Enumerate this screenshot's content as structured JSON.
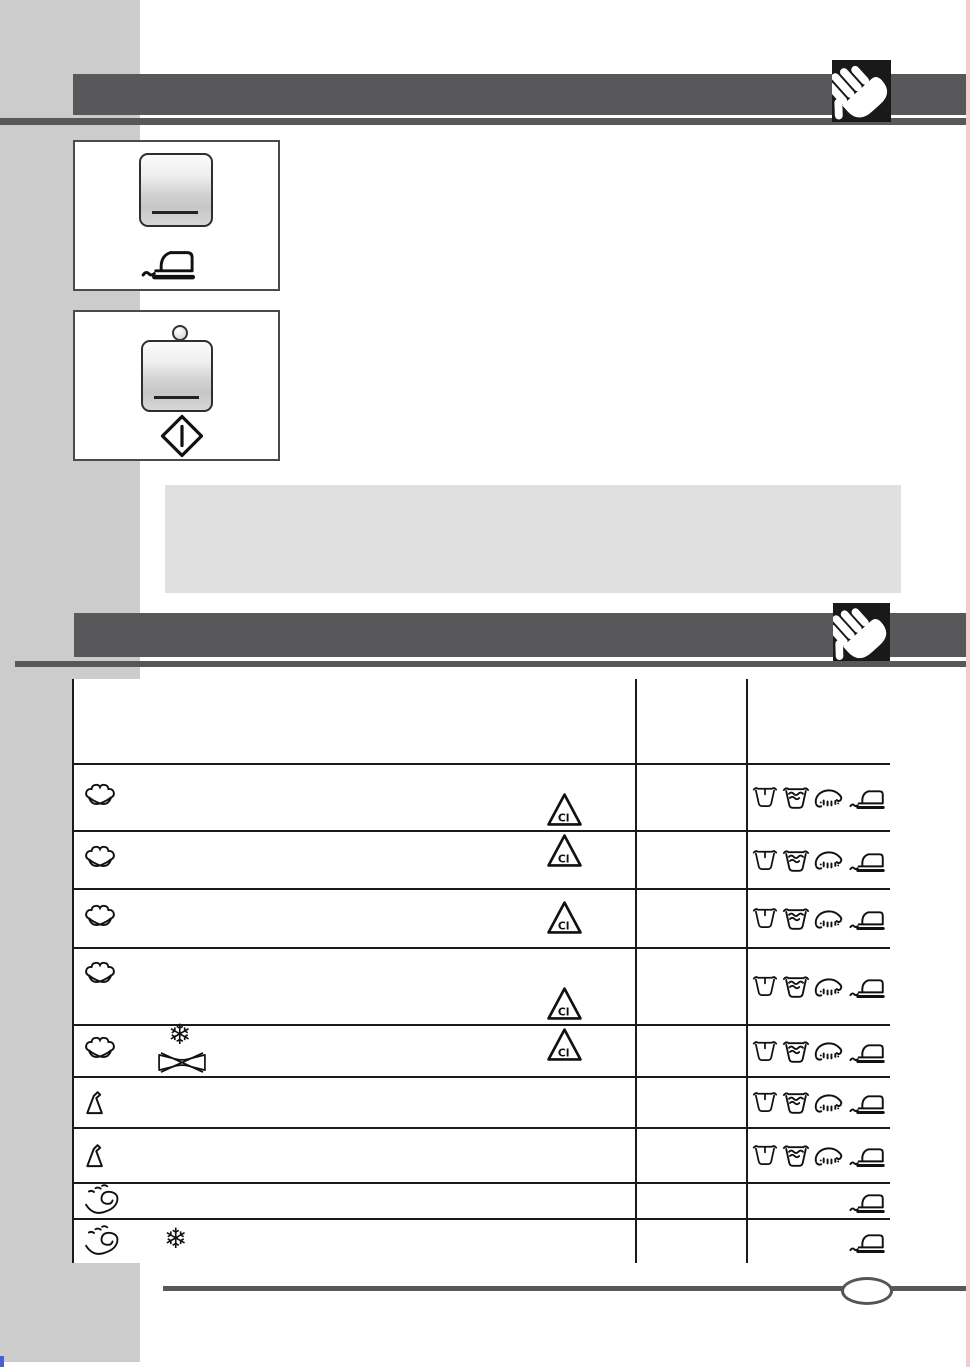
{
  "document": {
    "type": "washing-machine-manual-page",
    "visible_text": "Cl"
  },
  "colors": {
    "page_bg": "#ffffff",
    "sidebar": "#cccccc",
    "band_dark": "#58585a",
    "note_box": "#e0e0e0",
    "table_line": "#1a1a1a",
    "hand_box": "#191919",
    "scan_artifact_pink": "#f2cbcb",
    "scan_artifact_blue": "#4a5fd0"
  },
  "labels": {
    "bleach": "Cl"
  },
  "header1": {
    "icon": "hand-icon"
  },
  "header2": {
    "icon": "hand-icon"
  },
  "panels": [
    {
      "name": "easy-iron-button-panel",
      "elements": [
        "push-button",
        "iron-icon"
      ]
    },
    {
      "name": "start-button-panel",
      "elements": [
        "led-indicator",
        "push-button",
        "start-diamond-icon"
      ]
    }
  ],
  "note_box": {
    "text": ""
  },
  "table": {
    "header_row": {
      "col1": "",
      "col2": "",
      "col3": ""
    },
    "care_icon_legend": {
      "wash": "wash-tub-icon",
      "rinse": "rinse-tub-icon",
      "spin": "spin-dry-icon",
      "iron": "iron-icon"
    },
    "rows": [
      {
        "name": "cotton-program-1",
        "fabric": "cotton",
        "extras": [],
        "bleach": "bottom",
        "care": [
          "wash",
          "rinse",
          "spin",
          "iron"
        ]
      },
      {
        "name": "cotton-program-2",
        "fabric": "cotton",
        "extras": [],
        "bleach": "top",
        "care": [
          "wash",
          "rinse",
          "spin",
          "iron"
        ]
      },
      {
        "name": "cotton-program-3",
        "fabric": "cotton",
        "extras": [],
        "bleach": "center",
        "care": [
          "wash",
          "rinse",
          "spin",
          "iron"
        ]
      },
      {
        "name": "cotton-program-4",
        "fabric": "cotton",
        "extras": [],
        "bleach": "bottom",
        "care": [
          "wash",
          "rinse",
          "spin",
          "iron"
        ]
      },
      {
        "name": "cotton-cold-program",
        "fabric": "cotton",
        "extras": [
          "snowflake",
          "no-wring"
        ],
        "bleach": "top",
        "care": [
          "wash",
          "rinse",
          "spin",
          "iron"
        ]
      },
      {
        "name": "synthetics-program-1",
        "fabric": "synthetics",
        "extras": [],
        "bleach": null,
        "care": [
          "wash",
          "rinse",
          "spin",
          "iron"
        ]
      },
      {
        "name": "synthetics-program-2",
        "fabric": "synthetics",
        "extras": [],
        "bleach": null,
        "care": [
          "wash",
          "rinse",
          "spin",
          "iron"
        ]
      },
      {
        "name": "delicates-program-1",
        "fabric": "delicates",
        "extras": [],
        "bleach": null,
        "care": [
          "iron"
        ]
      },
      {
        "name": "delicates-cold-program",
        "fabric": "delicates",
        "extras": [
          "snowflake"
        ],
        "bleach": null,
        "care": [
          "iron"
        ]
      }
    ]
  },
  "footer": {
    "badge_text": ""
  }
}
